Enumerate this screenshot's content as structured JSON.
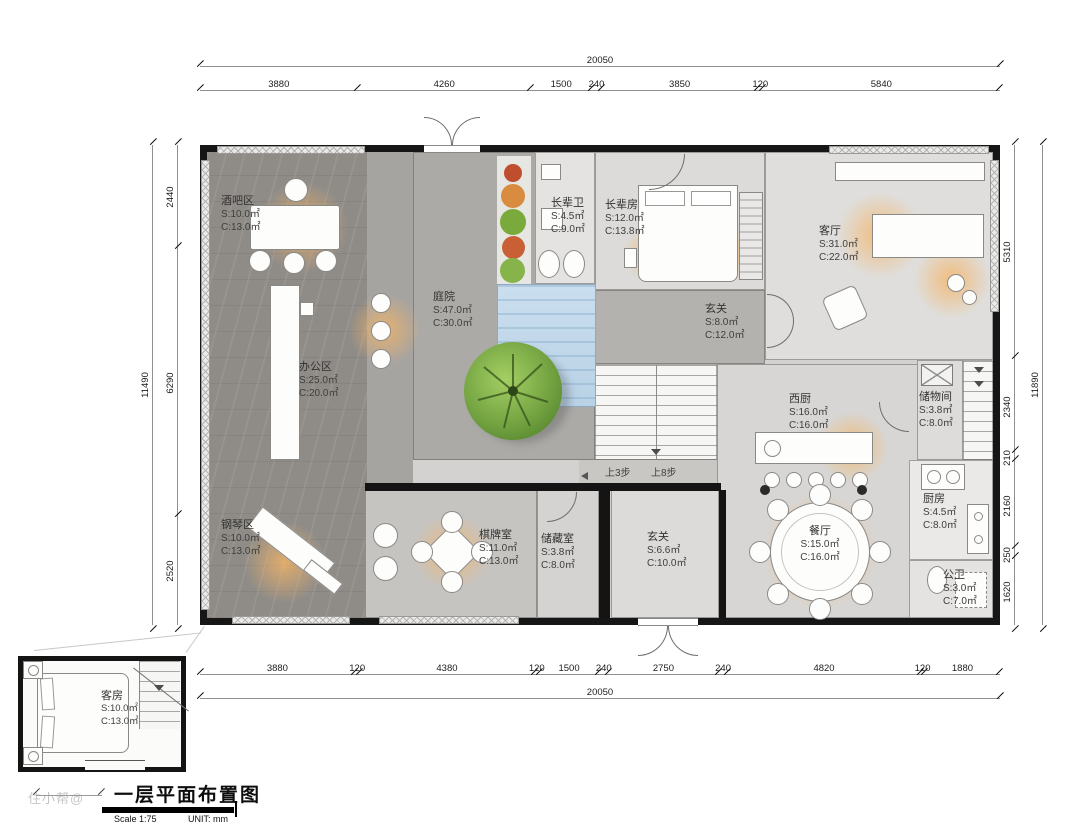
{
  "titleblock": {
    "title": "一层平面布置图",
    "scale": "Scale 1:75",
    "unit": "UNIT:  mm",
    "watermark": "住小帮@"
  },
  "dims": {
    "top": {
      "total": [
        "20050"
      ],
      "segments": [
        "3880",
        "4260",
        "1500",
        "240",
        "3850",
        "120",
        "5840"
      ]
    },
    "bottom": {
      "total": [
        "20050"
      ],
      "segments": [
        "3880",
        "120",
        "4380",
        "120",
        "1500",
        "240",
        "2750",
        "240",
        "4820",
        "120",
        "1880"
      ]
    },
    "left": {
      "total": [
        "11490"
      ],
      "segments": [
        "2440",
        "6290",
        "2520"
      ]
    },
    "right": {
      "total": [
        "11890"
      ],
      "segments": [
        "5310",
        "2340",
        "210",
        "2160",
        "250",
        "1620"
      ]
    }
  },
  "rooms": {
    "bar": {
      "name": "酒吧区",
      "s": "S:10.0㎡",
      "c": "C:13.0㎡"
    },
    "office": {
      "name": "办公区",
      "s": "S:25.0㎡",
      "c": "C:20.0㎡"
    },
    "piano": {
      "name": "钢琴区",
      "s": "S:10.0㎡",
      "c": "C:13.0㎡"
    },
    "courtyard": {
      "name": "庭院",
      "s": "S:47.0㎡",
      "c": "C:30.0㎡"
    },
    "elder_bath": {
      "name": "长辈卫",
      "s": "S:4.5㎡",
      "c": "C:9.0㎡"
    },
    "elder_room": {
      "name": "长辈房",
      "s": "S:12.0㎡",
      "c": "C:13.8㎡"
    },
    "living": {
      "name": "客厅",
      "s": "S:31.0㎡",
      "c": "C:22.0㎡"
    },
    "foyer_upper": {
      "name": "玄关",
      "s": "S:8.0㎡",
      "c": "C:12.0㎡"
    },
    "west_kitchen": {
      "name": "西厨",
      "s": "S:16.0㎡",
      "c": "C:16.0㎡"
    },
    "pantry": {
      "name": "储物间",
      "s": "S:3.8㎡",
      "c": "C:8.0㎡"
    },
    "kitchen": {
      "name": "厨房",
      "s": "S:4.5㎡",
      "c": "C:8.0㎡"
    },
    "dining": {
      "name": "餐厅",
      "s": "S:15.0㎡",
      "c": "C:16.0㎡"
    },
    "public_bath": {
      "name": "公卫",
      "s": "S:3.0㎡",
      "c": "C:7.0㎡"
    },
    "chess": {
      "name": "棋牌室",
      "s": "S:11.0㎡",
      "c": "C:13.0㎡"
    },
    "storage": {
      "name": "储藏室",
      "s": "S:3.8㎡",
      "c": "C:8.0㎡"
    },
    "foyer_lower": {
      "name": "玄关",
      "s": "S:6.6㎡",
      "c": "C:10.0㎡"
    },
    "guest": {
      "name": "客房",
      "s": "S:10.0㎡",
      "c": "C:13.0㎡"
    }
  },
  "annotations": {
    "steps_3": "上3步",
    "steps_8": "上8步"
  },
  "colors": {
    "wall": "#161616",
    "dark_floor": "#8f8c88",
    "courtyard": "#abaaa7",
    "light_floor": "#dedddb",
    "water": "#c6dbec",
    "tree": "#73a341",
    "glow": "#f6b464"
  }
}
